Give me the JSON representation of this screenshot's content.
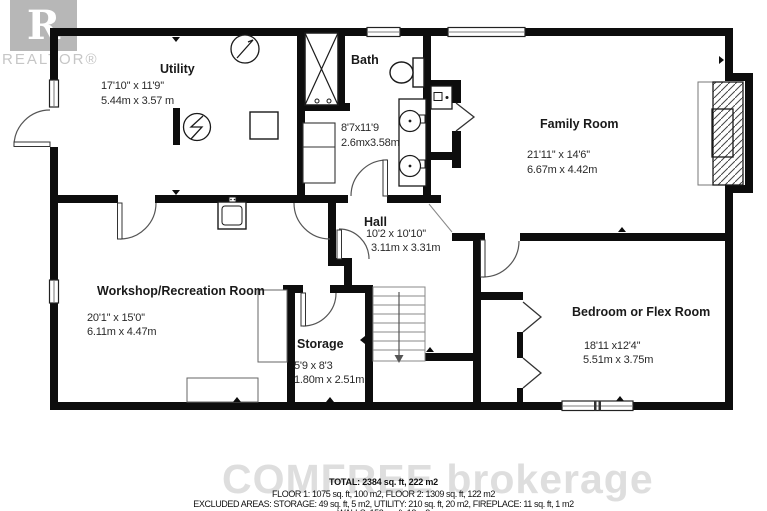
{
  "branding": {
    "realtor_logo_letter": "R",
    "realtor_wordmark": "REALTOR®",
    "footer_watermark": "COMFREE brokerage"
  },
  "rooms": {
    "utility": {
      "name": "Utility",
      "size_ft": "17'10'' x 11'9''",
      "size_m": "5.44m x 3.57 m"
    },
    "bath": {
      "name": "Bath",
      "size_ft": "8'7x11'9",
      "size_m": "2.6mx3.58m"
    },
    "family": {
      "name": "Family Room",
      "size_ft": "21'11'' x 14'6''",
      "size_m": "6.67m x 4.42m"
    },
    "hall": {
      "name": "Hall",
      "size_ft": "10'2 x 10'10''",
      "size_m": "3.11m x 3.31m"
    },
    "workshop": {
      "name": "Workshop/Recreation Room",
      "size_ft": "20'1'' x 15'0''",
      "size_m": "6.11m x 4.47m"
    },
    "storage": {
      "name": "Storage",
      "size_ft": "5'9 x 8'3",
      "size_m": "1.80m x 2.51m"
    },
    "bedroom": {
      "name": "Bedroom or Flex Room",
      "size_ft": "18'11 x12'4''",
      "size_m": "5.51m x 3.75m"
    }
  },
  "summary": {
    "total": "TOTAL: 2384 sq. ft, 222 m2",
    "floors": "FLOOR 1: 1075 sq. ft, 100 m2, FLOOR 2: 1309 sq. ft, 122 m2",
    "excluded": "EXCLUDED AREAS: STORAGE: 49 sq. ft, 5 m2, UTILITY: 210 sq. ft, 20 m2, FIREPLACE: 11 sq. ft, 1 m2",
    "walls": "WALLS: 152 sq. ft, 13 m2"
  },
  "icons": {
    "electrical_panel": "circle-zigzag",
    "ceiling_fixture": "circle-needle",
    "stairs_direction": "arrow-down",
    "shower": "crossed-box",
    "closet_doors": "chevron-bifold"
  },
  "colors": {
    "wall": "#0d0d0d",
    "watermark_gray": "#dedede",
    "logo_gray": "#ababab"
  }
}
